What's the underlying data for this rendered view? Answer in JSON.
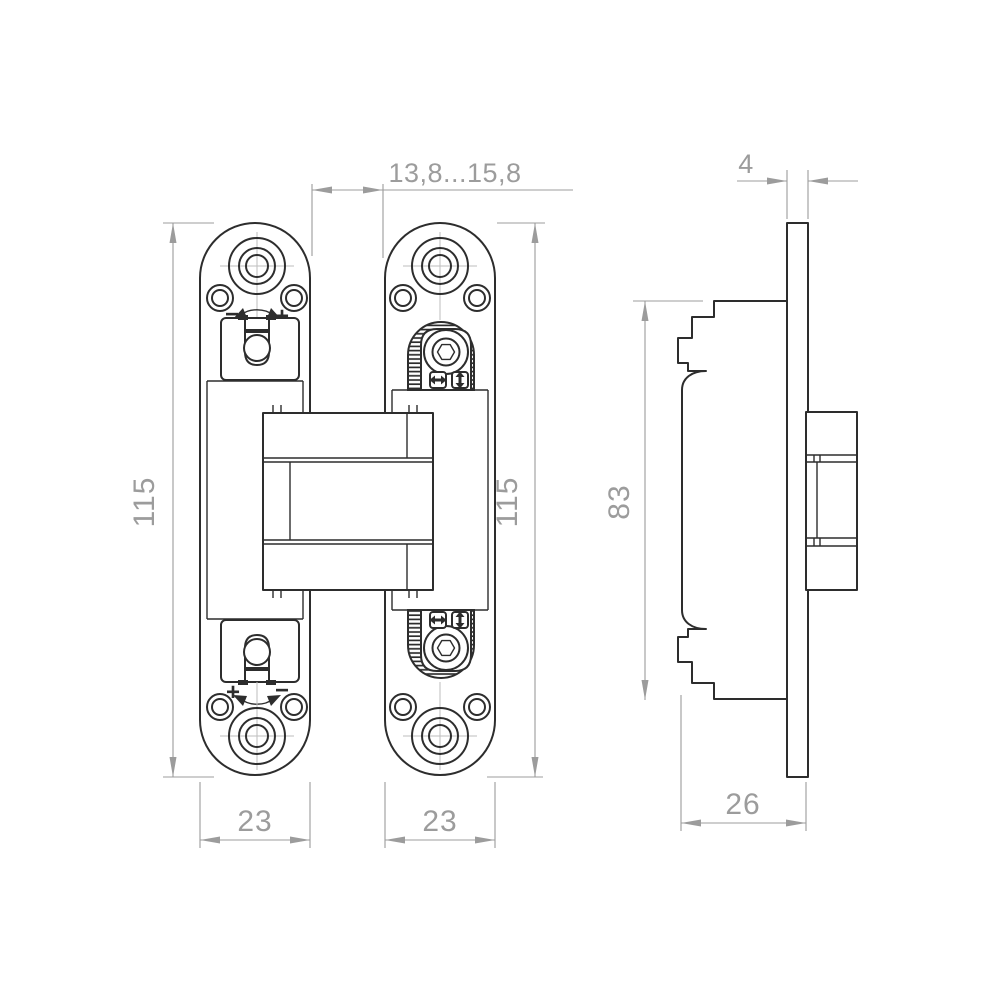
{
  "drawing": {
    "kind": "concealed-hinge-technical-drawing",
    "views": [
      "front-view-left-wing",
      "front-view-right-wing",
      "side-view"
    ],
    "colors": {
      "background": "#ffffff",
      "object_line": "#2d2d2d",
      "dimension_line": "#9c9c9c",
      "centerline": "#bdbdbd"
    },
    "icons": {
      "rotation_arrow": "curved-double-arrow",
      "horizontal_adjust": "left-right-arrow",
      "vertical_adjust": "up-down-arrow",
      "hex_socket_screw": "hexagon-in-circles",
      "knurled_wheel": "hatched-dome"
    }
  },
  "dimensions": {
    "gap": "13,8...15,8",
    "plate_thickness": "4",
    "height_left": "115",
    "height_right": "115",
    "cup_height": "83",
    "width_left": "23",
    "width_right": "23",
    "depth": "26"
  },
  "marks": {
    "top_minus": "−",
    "top_plus": "+",
    "bottom_plus": "+",
    "bottom_minus": "−"
  }
}
